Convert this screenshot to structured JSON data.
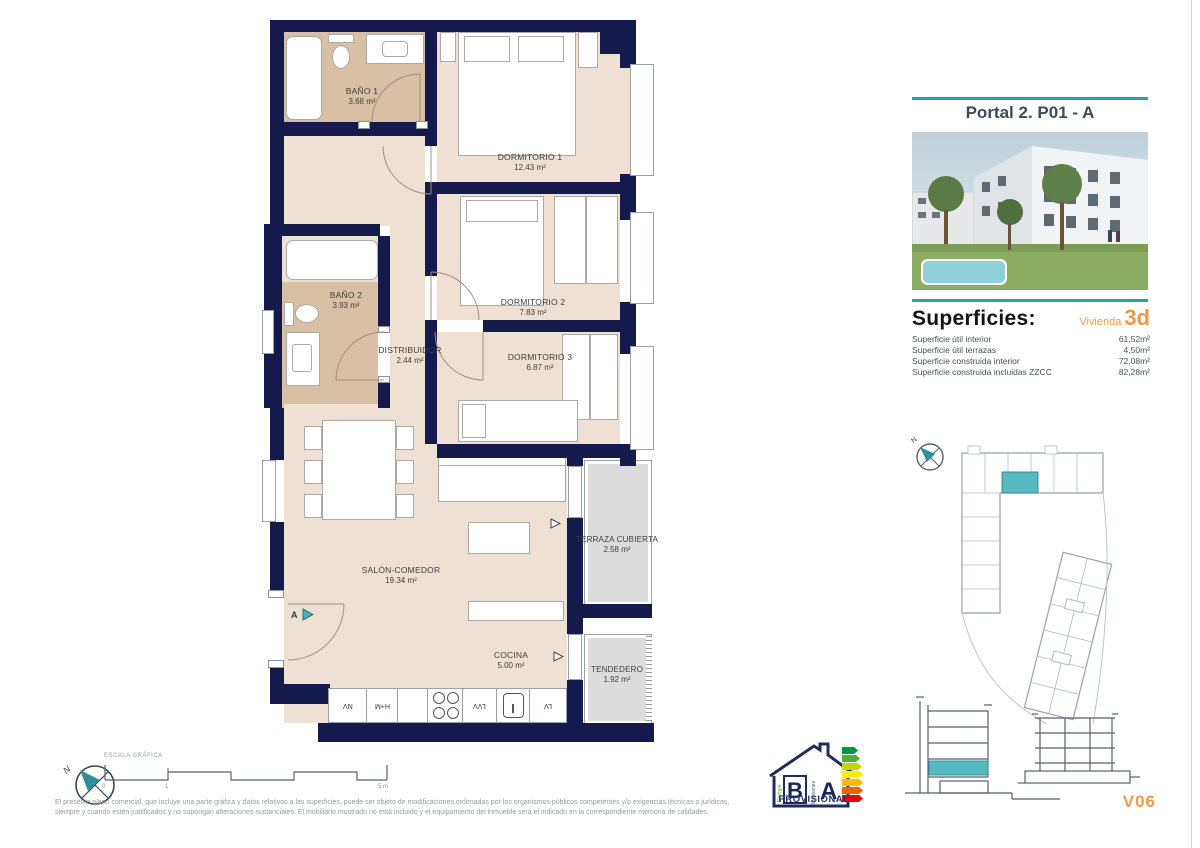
{
  "plan": {
    "rooms": [
      {
        "name": "BAÑO 1",
        "area": "3.68 m²"
      },
      {
        "name": "DORMITORIO 1",
        "area": "12.43 m²"
      },
      {
        "name": "BAÑO 2",
        "area": "3.93 m²"
      },
      {
        "name": "DISTRIBUIDOR",
        "area": "2.44 m²"
      },
      {
        "name": "DORMITORIO 2",
        "area": "7.83 m²"
      },
      {
        "name": "DORMITORIO 3",
        "area": "6.87 m²"
      },
      {
        "name": "SALÓN-COMEDOR",
        "area": "19.34 m²"
      },
      {
        "name": "TERRAZA CUBIERTA",
        "area": "2.58 m²"
      },
      {
        "name": "COCINA",
        "area": "5.00 m²"
      },
      {
        "name": "TENDEDERO",
        "area": "1.92 m²"
      }
    ],
    "kitchen_labels": [
      "NV",
      "H+M",
      "LVV",
      "LV"
    ],
    "section_marker": "A",
    "colors": {
      "wall_navy": "#141a4b",
      "floor_beige": "#eee0d3",
      "floor_wet": "#d9bfa4",
      "floor_outdoor": "#dcdcdc",
      "accent_teal": "#4ab5bf"
    }
  },
  "sidebar": {
    "portal_title": "Portal 2. P01 - A",
    "superficies_title": "Superficies:",
    "vivienda_label": "Vivienda",
    "vivienda_code": "3d",
    "surface_rows": [
      {
        "label": "Superficie útil interior",
        "value": "61,52m²"
      },
      {
        "label": "Superficie útil terrazas",
        "value": "4,50m²"
      },
      {
        "label": "Superficie construida interior",
        "value": "72,08m²"
      },
      {
        "label": "Superficie construida incluidas ZZCC",
        "value": "82,28m²"
      }
    ],
    "version": "V06",
    "accent_teal": "#2aa0ad",
    "accent_orange": "#f09a45"
  },
  "footer": {
    "scale_label": "ESCALA GRÁFICA",
    "scale_tick_start": "0",
    "scale_tick_one": "1",
    "scale_tick_end": "5 m",
    "north_label": "N",
    "disclaimer_line1": "El presente plano comercial, que incluye una parte gráfica y datos relativos a las superficies, puede ser objeto de modificaciones ordenadas por los organismos públicos competentes y/o exigencias técnicas o jurídicas,",
    "disclaimer_line2": "siempre y cuando estén justificados y no supongan alteraciones sustanciales. El mobiliario mostrado no está incluido y el equipamiento del inmueble será el indicado en la correspondiente memoria de calidades.",
    "energy": {
      "letter_b": "B",
      "letter_a": "A",
      "word_left": "Energía",
      "word_right": "Emisiones",
      "provisional": "PROVISIONAL",
      "scale_colors": [
        "#009640",
        "#52ae32",
        "#c8d400",
        "#ffed00",
        "#fbba00",
        "#ec6608",
        "#e30613"
      ]
    }
  }
}
